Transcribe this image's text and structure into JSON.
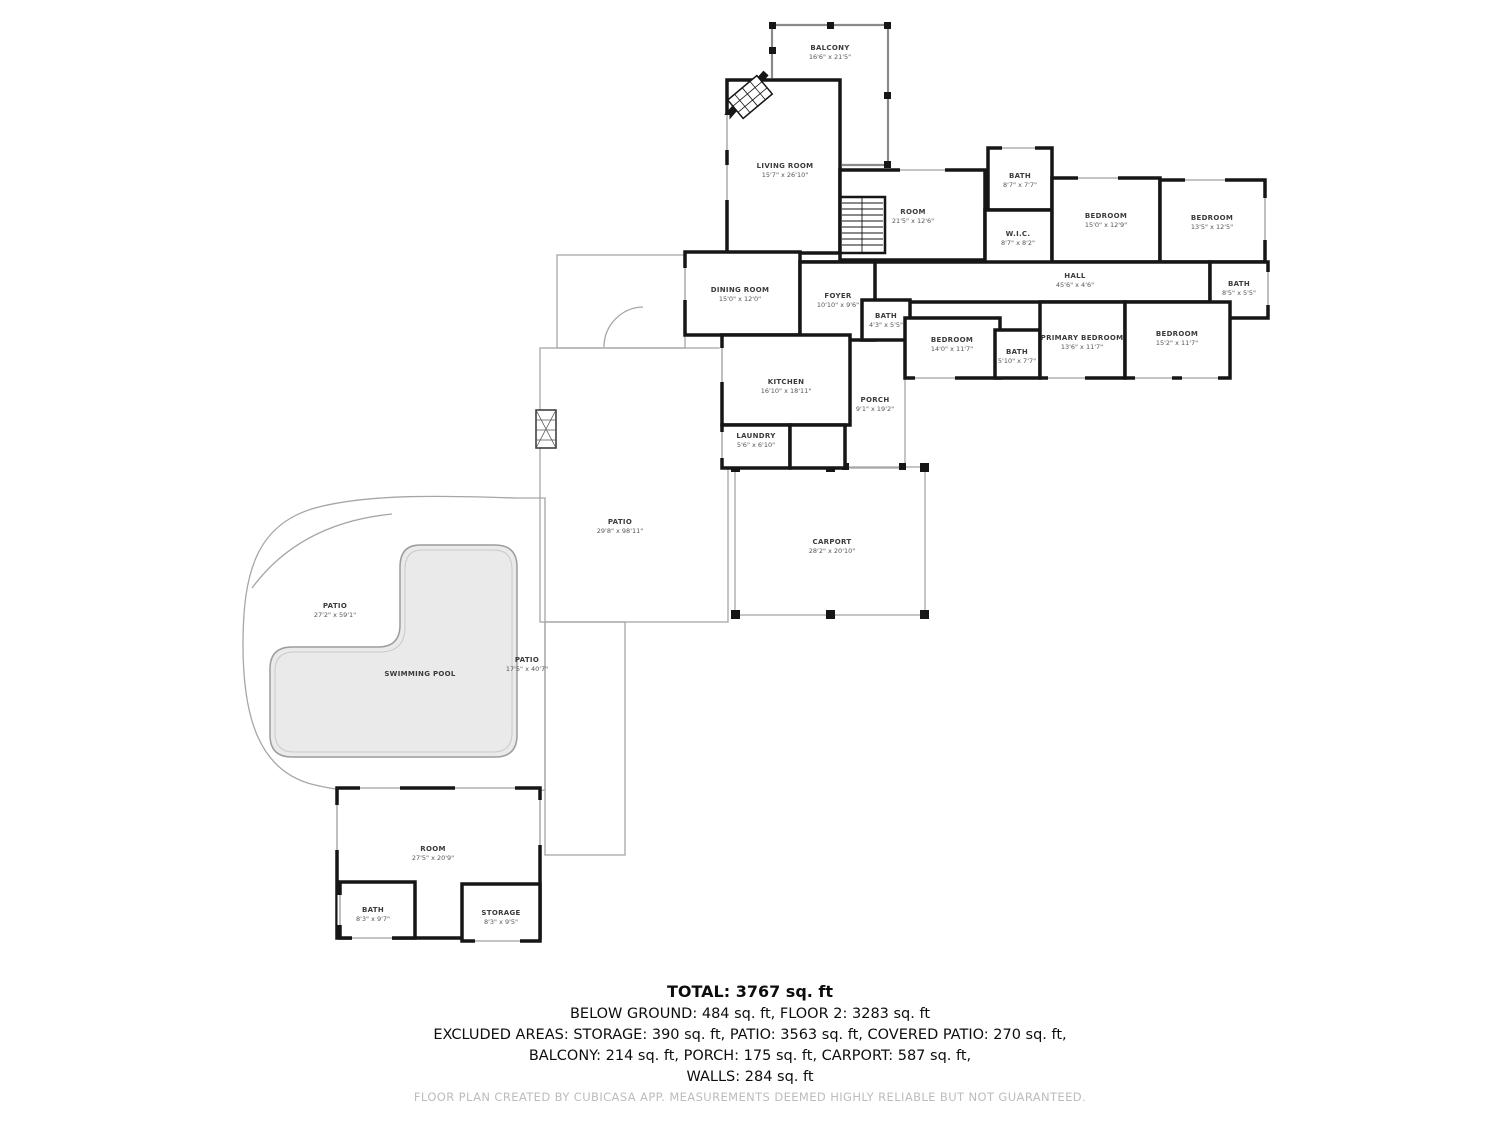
{
  "floorplan": {
    "rooms": [
      {
        "id": "balcony",
        "name": "BALCONY",
        "dims": "16'6\" x 21'5\""
      },
      {
        "id": "living-room",
        "name": "LIVING ROOM",
        "dims": "15'7\" x 26'10\""
      },
      {
        "id": "room-upper",
        "name": "ROOM",
        "dims": "21'5\" x 12'6\""
      },
      {
        "id": "bath-upper",
        "name": "BATH",
        "dims": "8'7\" x 7'7\""
      },
      {
        "id": "wic",
        "name": "W.I.C.",
        "dims": "8'7\" x 8'2\""
      },
      {
        "id": "bedroom-1",
        "name": "BEDROOM",
        "dims": "15'0\" x 12'9\""
      },
      {
        "id": "bedroom-2",
        "name": "BEDROOM",
        "dims": "13'5\" x 12'5\""
      },
      {
        "id": "hall",
        "name": "HALL",
        "dims": "45'6\" x 4'6\""
      },
      {
        "id": "bath-hall",
        "name": "BATH",
        "dims": "8'5\" x 5'5\""
      },
      {
        "id": "dining-room",
        "name": "DINING ROOM",
        "dims": "15'0\" x 12'0\""
      },
      {
        "id": "foyer",
        "name": "FOYER",
        "dims": "10'10\" x 9'6\""
      },
      {
        "id": "bath-foyer",
        "name": "BATH",
        "dims": "4'3\" x 5'5\""
      },
      {
        "id": "bedroom-3",
        "name": "BEDROOM",
        "dims": "14'0\" x 11'7\""
      },
      {
        "id": "bath-primary",
        "name": "BATH",
        "dims": "5'10\" x 7'7\""
      },
      {
        "id": "primary-bedroom",
        "name": "PRIMARY BEDROOM",
        "dims": "13'6\" x 11'7\""
      },
      {
        "id": "bedroom-4",
        "name": "BEDROOM",
        "dims": "15'2\" x 11'7\""
      },
      {
        "id": "kitchen",
        "name": "KITCHEN",
        "dims": "16'10\" x 18'11\""
      },
      {
        "id": "laundry",
        "name": "LAUNDRY",
        "dims": "5'6\" x 6'10\""
      },
      {
        "id": "porch",
        "name": "PORCH",
        "dims": "9'1\" x 19'2\""
      },
      {
        "id": "patio-main",
        "name": "PATIO",
        "dims": "29'8\" x 98'11\""
      },
      {
        "id": "carport",
        "name": "CARPORT",
        "dims": "28'2\" x 20'10\""
      },
      {
        "id": "patio-pool",
        "name": "PATIO",
        "dims": "27'2\" x 59'1\""
      },
      {
        "id": "swimming-pool",
        "name": "SWIMMING POOL",
        "dims": ""
      },
      {
        "id": "patio-side",
        "name": "PATIO",
        "dims": "17'5\" x 40'7\""
      },
      {
        "id": "room-lower",
        "name": "ROOM",
        "dims": "27'5\" x 20'9\""
      },
      {
        "id": "bath-lower",
        "name": "BATH",
        "dims": "8'3\" x 9'7\""
      },
      {
        "id": "storage",
        "name": "STORAGE",
        "dims": "8'3\" x 9'5\""
      }
    ],
    "summary": {
      "total": "TOTAL: 3767 sq. ft",
      "line2": "BELOW GROUND: 484 sq. ft, FLOOR 2: 3283 sq. ft",
      "line3": "EXCLUDED AREAS: STORAGE: 390 sq. ft, PATIO: 3563 sq. ft, COVERED PATIO: 270 sq. ft,",
      "line4": "BALCONY: 214 sq. ft, PORCH: 175 sq. ft, CARPORT: 587 sq. ft,",
      "line5": "WALLS: 284 sq. ft"
    },
    "footer": "FLOOR PLAN CREATED BY CUBICASA APP. MEASUREMENTS DEEMED HIGHLY RELIABLE BUT NOT GUARANTEED.",
    "colors": {
      "wall": "#161616",
      "outline": "#a6a6a6",
      "pool_fill": "#eaeaea",
      "label_text": "#3b3b3b",
      "footer_text": "#bcbcbc"
    }
  }
}
